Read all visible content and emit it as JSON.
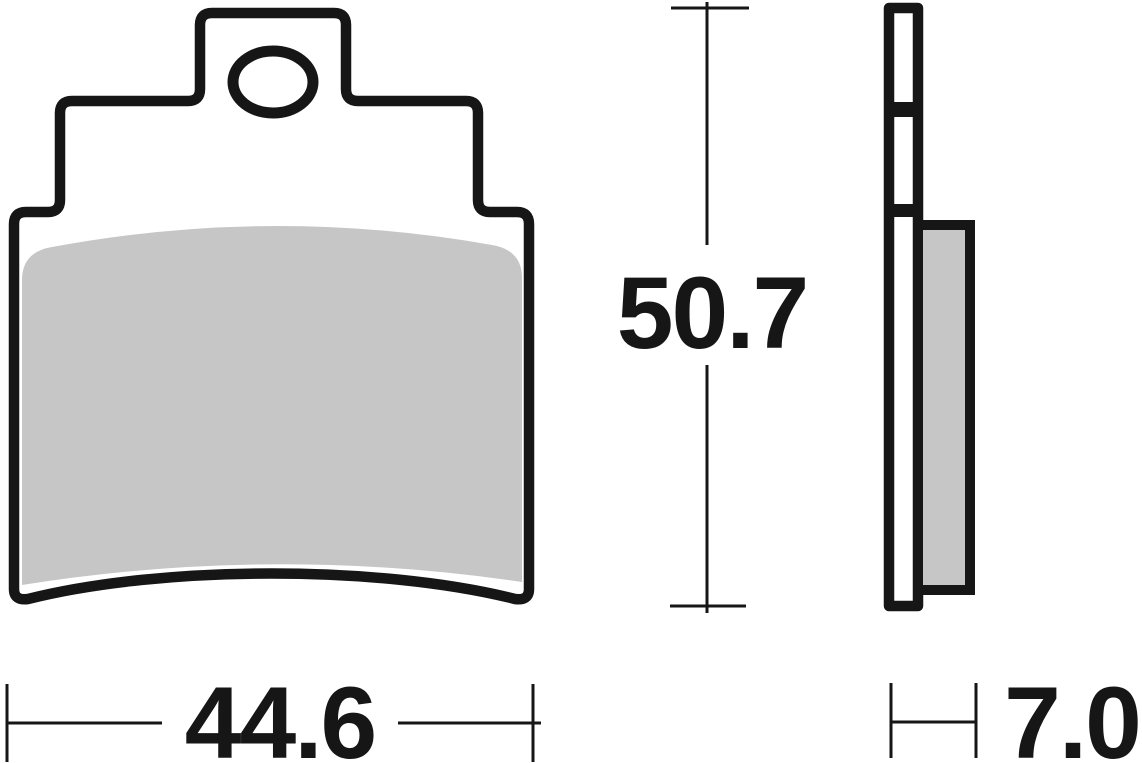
{
  "drawing": {
    "dimensions": {
      "width": "44.6",
      "height": "50.7",
      "thickness": "7.0"
    },
    "colors": {
      "line": "#161616",
      "friction_material": "#c6c6c6",
      "backing_plate_fill": "#ffffff",
      "background": "#ffffff"
    }
  }
}
